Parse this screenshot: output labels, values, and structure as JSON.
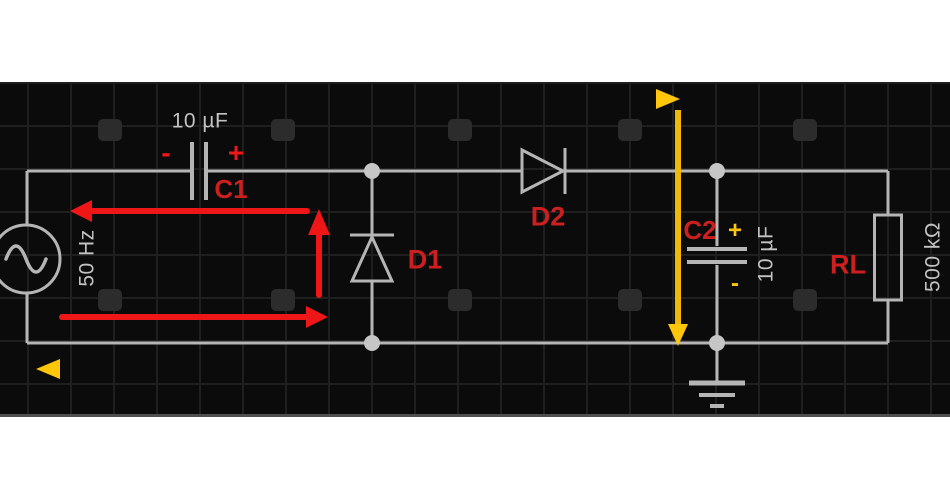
{
  "page_title": "AC circuit diagram",
  "colors": {
    "page_bg": "#ffffff",
    "canvas_bg": "#0b0b0b",
    "grid": "#1f1f1f",
    "pad": "#2c2c2c",
    "wire": "#b5b5b5",
    "dot": "#c6c6c6",
    "text_gray": "#c2c2c2",
    "label_red": "#cd1f1f",
    "arrow_red": "#ee1616",
    "arrow_yellow": "#f2b808",
    "arrow_yellow_bright": "#ffc60a",
    "arrow_yellow_dark": "#8f7a10",
    "edge": "#4f4f4f"
  },
  "components": {
    "source": {
      "frequency": "50 Hz"
    },
    "c1": {
      "label": "C1",
      "value": "10 µF",
      "negative_sign": "-",
      "positive_sign": "+"
    },
    "d1": {
      "label": "D1"
    },
    "d2": {
      "label": "D2"
    },
    "c2": {
      "label": "C2",
      "value": "10 µF",
      "positive_sign": "+",
      "negative_sign": "-"
    },
    "rl": {
      "label": "RL",
      "value": "500 kΩ"
    }
  }
}
